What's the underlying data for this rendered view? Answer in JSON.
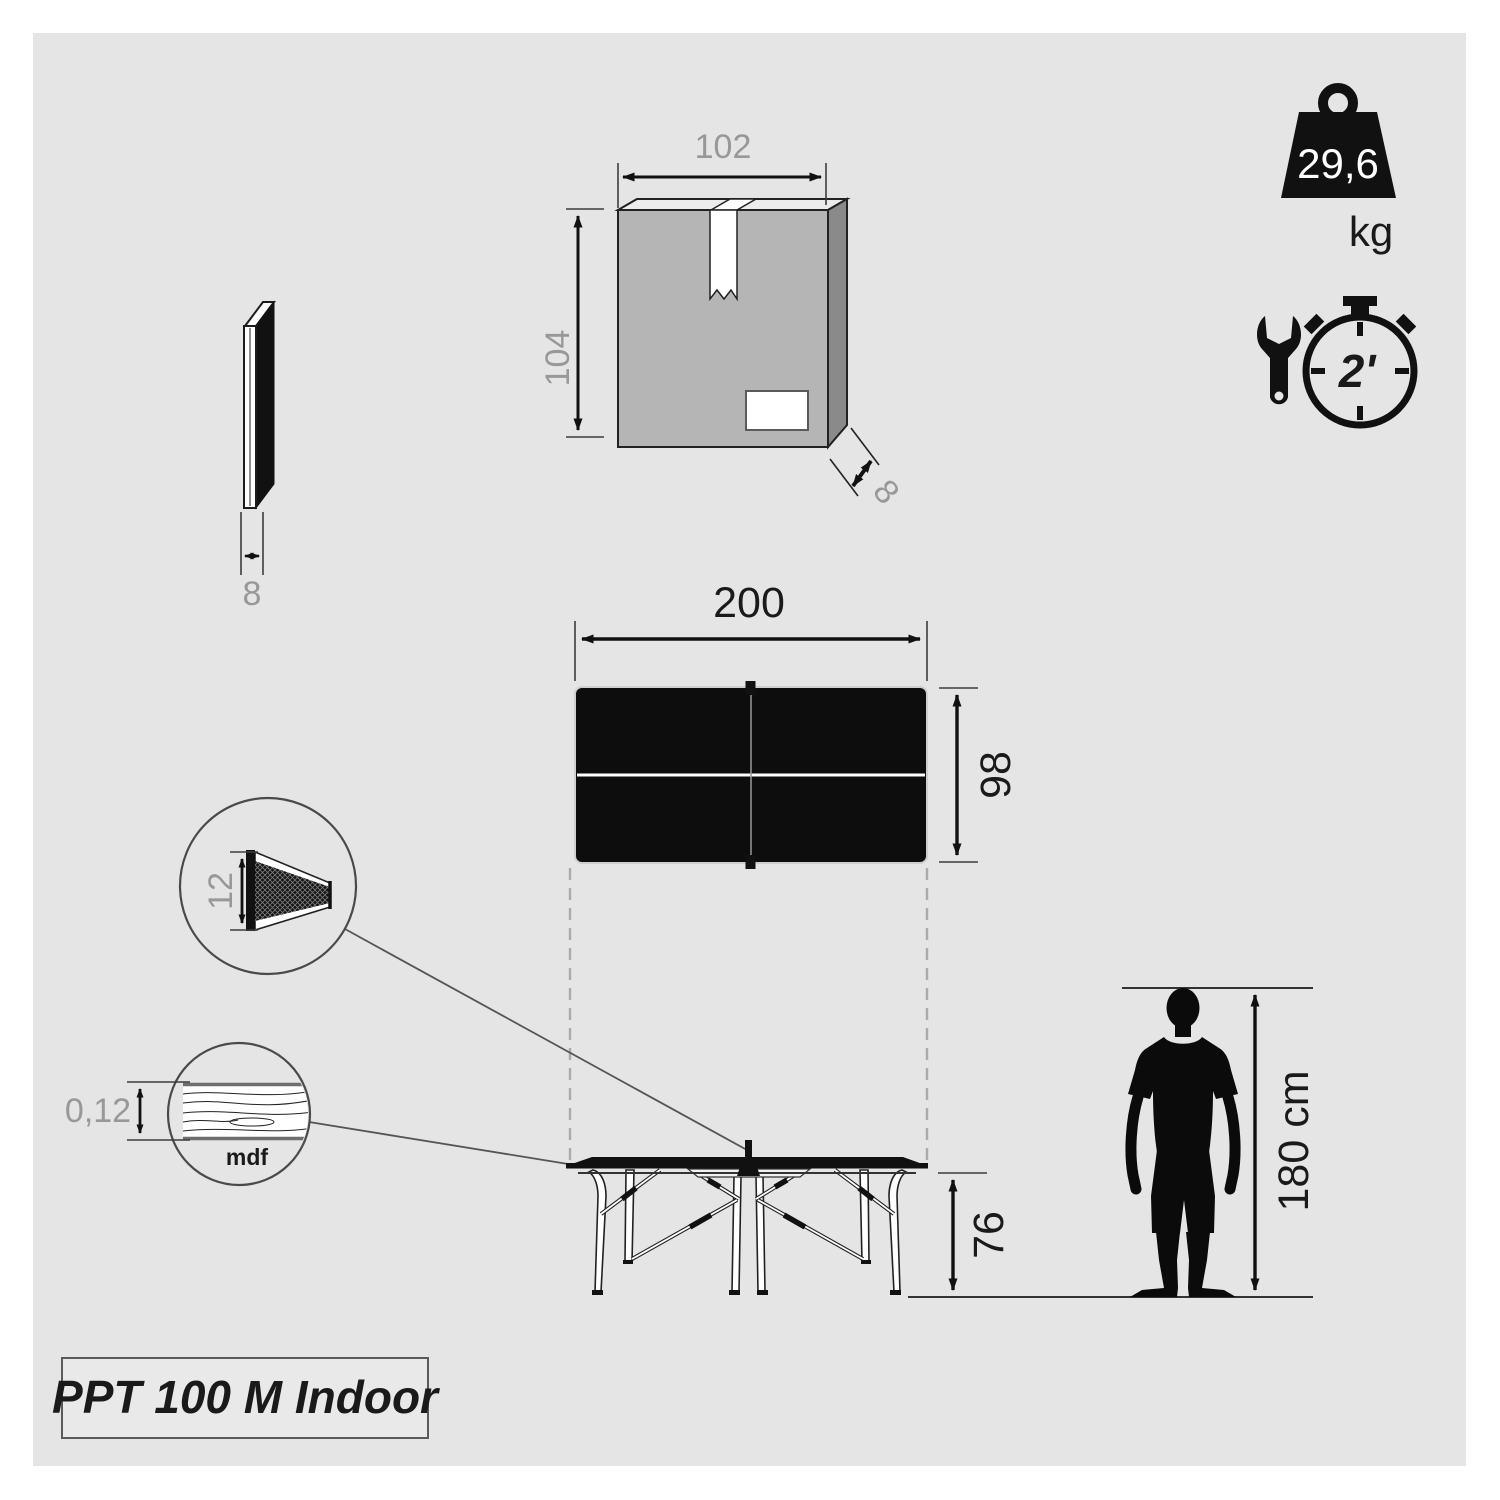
{
  "product": {
    "label": "PPT 100 M Indoor"
  },
  "badges": {
    "weight": {
      "value": "29,6",
      "unit": "kg"
    },
    "assembly": {
      "time": "2'"
    }
  },
  "dimensions": {
    "package": {
      "width": "102",
      "height": "104",
      "depth": "8"
    },
    "panel_thickness": "8",
    "table": {
      "length": "200",
      "width": "98",
      "height": "76"
    },
    "net_height": "12",
    "top_thickness": "0,12",
    "top_material": "mdf",
    "person_height": "180 cm"
  },
  "colors": {
    "canvas": "#e5e5e5",
    "box_front": "#b5b5b5",
    "box_side": "#8a8a8a",
    "box_top": "#ececec",
    "ink": "#111111",
    "dim_gray_text": "#989898"
  }
}
